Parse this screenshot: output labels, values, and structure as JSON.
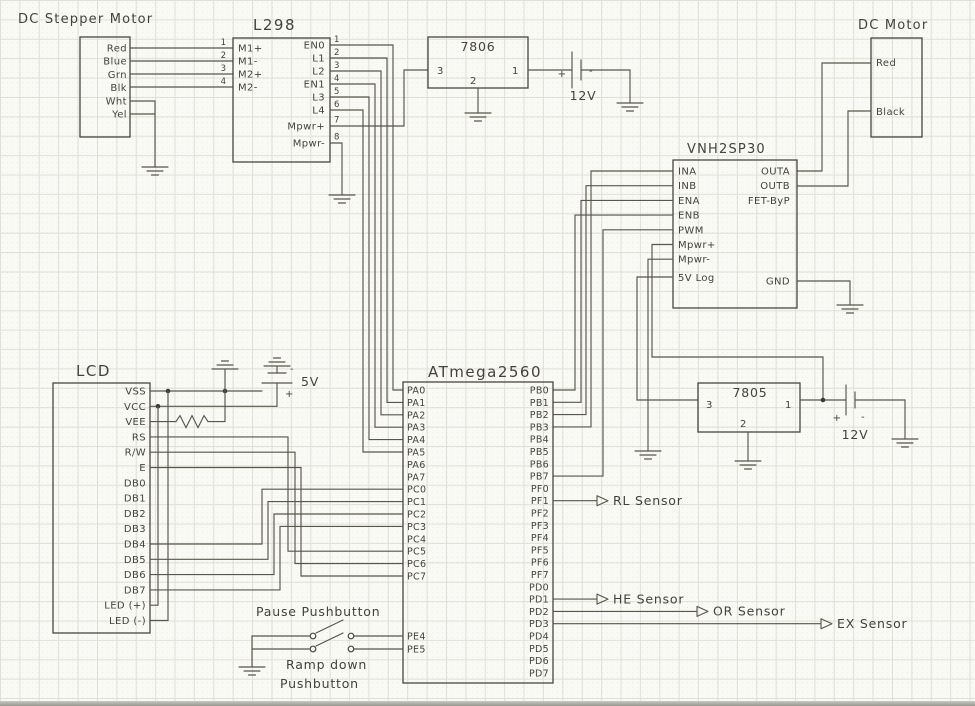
{
  "palette": {
    "ink": "#45423d",
    "wire": "#595549",
    "paper": "#f9f9f5",
    "grid": "#dde1d6"
  },
  "components": {
    "stepper": {
      "title": "DC Stepper Motor",
      "pins": [
        "Red",
        "Blue",
        "Grn",
        "Blk",
        "Wht",
        "Yel"
      ],
      "wire_numbers": [
        "1",
        "2",
        "3",
        "4"
      ]
    },
    "l298": {
      "title": "L298",
      "left_pins": [
        "M1+",
        "M1-",
        "M2+",
        "M2-"
      ],
      "right_pins": [
        "EN0",
        "L1",
        "L2",
        "EN1",
        "L3",
        "L4"
      ],
      "mpwr_plus": "Mpwr+",
      "mpwr_minus": "Mpwr-",
      "right_numbers": [
        "1",
        "2",
        "3",
        "4",
        "5",
        "6"
      ],
      "num7": "7",
      "num8": "8"
    },
    "reg7806": {
      "title": "7806",
      "pin_out": "3",
      "pin_in": "1",
      "pin_gnd": "2"
    },
    "battery_12v_top": {
      "label": "12V",
      "plus": "+",
      "minus": "-"
    },
    "dc_motor": {
      "title": "DC Motor",
      "pin_red": "Red",
      "pin_black": "Black"
    },
    "vnh2sp30": {
      "title": "VNH2SP30",
      "left_pins": [
        "INA",
        "INB",
        "ENA",
        "ENB",
        "PWM",
        "Mpwr+",
        "Mpwr-"
      ],
      "pin_5vlog": "5V Log",
      "pin_outa": "OUTA",
      "pin_outb": "OUTB",
      "pin_fetbyp": "FET-ByP",
      "pin_gnd": "GND"
    },
    "atmega": {
      "title": "ATmega2560",
      "left_pins": [
        "PA0",
        "PA1",
        "PA2",
        "PA3",
        "PA4",
        "PA5",
        "PA6",
        "PA7",
        "PC0",
        "PC1",
        "PC2",
        "PC3",
        "PC4",
        "PC5",
        "PC6",
        "PC7"
      ],
      "pe_pins": [
        "PE4",
        "PE5"
      ],
      "right_pins": [
        "PB0",
        "PB1",
        "PB2",
        "PB3",
        "PB4",
        "PB5",
        "PB6",
        "PB7",
        "PF0",
        "PF1",
        "PF2",
        "PF3",
        "PF4",
        "PF5",
        "PF6",
        "PF7",
        "PD0",
        "PD1",
        "PD2",
        "PD3",
        "PD4",
        "PD5",
        "PD6",
        "PD7"
      ]
    },
    "lcd": {
      "title": "LCD",
      "pins": [
        "VSS",
        "VCC",
        "VEE",
        "RS",
        "R/W",
        "E",
        "DB0",
        "DB1",
        "DB2",
        "DB3",
        "DB4",
        "DB5",
        "DB6",
        "DB7",
        "LED (+)",
        "LED (-)"
      ]
    },
    "battery_5v": {
      "label": "5V",
      "plus": "+",
      "minus": "-"
    },
    "reg7805": {
      "title": "7805",
      "pin_out": "3",
      "pin_in": "1",
      "pin_gnd": "2"
    },
    "battery_12v_right": {
      "label": "12V",
      "plus": "+",
      "minus": "-"
    }
  },
  "annotations": {
    "sensor_rl": "RL Sensor",
    "sensor_he": "HE Sensor",
    "sensor_or": "OR Sensor",
    "sensor_ex": "EX Sensor",
    "pause_label": "Pause Pushbutton",
    "ramp_label_line1": "Ramp down",
    "ramp_label_line2": "Pushbutton"
  }
}
